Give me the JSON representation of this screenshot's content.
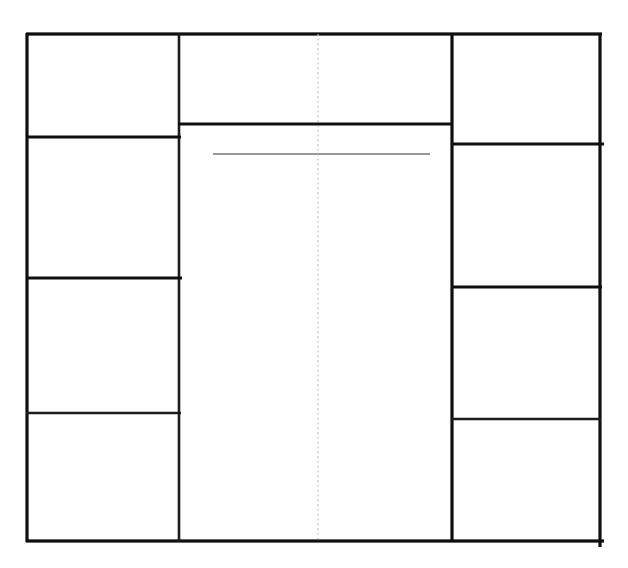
{
  "canvas": {
    "width": 628,
    "height": 568,
    "background": "#ffffff"
  },
  "colors": {
    "primary_line": "#0f0f0f",
    "secondary_line": "#1c1c1c",
    "gray_rule": "#757575",
    "dotted_guide": "#b4b4b4"
  },
  "diagram": {
    "lines": [
      {
        "name": "outer-border-top",
        "x1": 26,
        "y1": 34,
        "x2": 602,
        "y2": 34,
        "width": 3.2,
        "color": "#0f0f0f",
        "dash": ""
      },
      {
        "name": "outer-border-bottom",
        "x1": 26,
        "y1": 541,
        "x2": 604,
        "y2": 541,
        "width": 3.2,
        "color": "#0f0f0f",
        "dash": ""
      },
      {
        "name": "outer-border-left",
        "x1": 27,
        "y1": 33,
        "x2": 27,
        "y2": 542,
        "width": 3.2,
        "color": "#0f0f0f",
        "dash": ""
      },
      {
        "name": "outer-border-right",
        "x1": 600,
        "y1": 33,
        "x2": 600,
        "y2": 547,
        "width": 3.2,
        "color": "#0f0f0f",
        "dash": ""
      },
      {
        "name": "center-left-wall",
        "x1": 179,
        "y1": 33,
        "x2": 179,
        "y2": 542,
        "width": 2.6,
        "color": "#1c1c1c",
        "dash": ""
      },
      {
        "name": "center-right-wall",
        "x1": 452,
        "y1": 33,
        "x2": 452,
        "y2": 542,
        "width": 3.2,
        "color": "#0f0f0f",
        "dash": ""
      },
      {
        "name": "left-cell-divider-1",
        "x1": 26,
        "y1": 137,
        "x2": 181,
        "y2": 137,
        "width": 3.0,
        "color": "#0f0f0f",
        "dash": ""
      },
      {
        "name": "left-cell-divider-2",
        "x1": 26,
        "y1": 278,
        "x2": 182,
        "y2": 278,
        "width": 3.0,
        "color": "#0f0f0f",
        "dash": ""
      },
      {
        "name": "left-cell-divider-3",
        "x1": 26,
        "y1": 413,
        "x2": 181,
        "y2": 413,
        "width": 2.6,
        "color": "#1c1c1c",
        "dash": ""
      },
      {
        "name": "right-cell-divider-1",
        "x1": 451,
        "y1": 144,
        "x2": 604,
        "y2": 144,
        "width": 3.0,
        "color": "#0f0f0f",
        "dash": ""
      },
      {
        "name": "right-cell-divider-2",
        "x1": 451,
        "y1": 287,
        "x2": 602,
        "y2": 287,
        "width": 3.0,
        "color": "#0f0f0f",
        "dash": ""
      },
      {
        "name": "right-cell-divider-3",
        "x1": 451,
        "y1": 419,
        "x2": 601,
        "y2": 419,
        "width": 2.6,
        "color": "#1c1c1c",
        "dash": ""
      },
      {
        "name": "center-header-divider",
        "x1": 178,
        "y1": 124,
        "x2": 452,
        "y2": 124,
        "width": 3.0,
        "color": "#0f0f0f",
        "dash": ""
      },
      {
        "name": "center-gray-rule",
        "x1": 213,
        "y1": 154,
        "x2": 430,
        "y2": 154,
        "width": 1.6,
        "color": "#757575",
        "dash": ""
      },
      {
        "name": "center-dotted-guide",
        "x1": 318,
        "y1": 34,
        "x2": 318,
        "y2": 541,
        "width": 1.2,
        "color": "#b4b4b4",
        "dash": "1.6 3.2"
      }
    ]
  }
}
